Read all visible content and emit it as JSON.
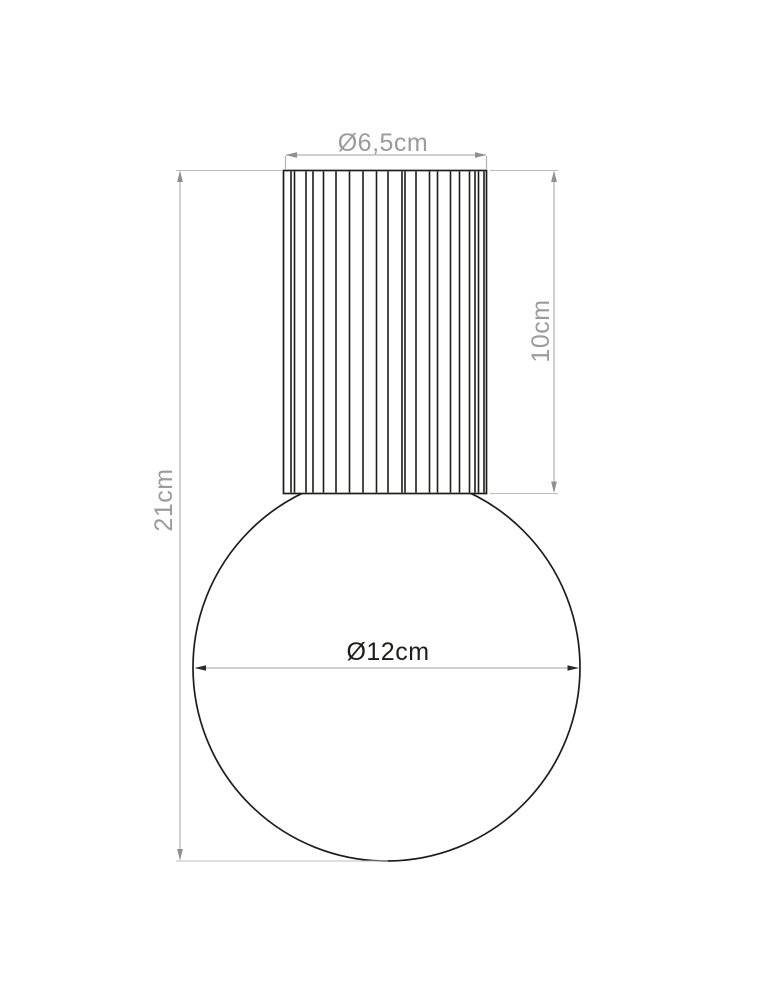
{
  "drawing": {
    "labels": {
      "top_diameter": "Ø6,5cm",
      "cylinder_height": "10cm",
      "total_height": "21cm",
      "globe_diameter": "Ø12cm"
    },
    "colors": {
      "object_line": "#1d1d1b",
      "dimension_line": "#b2b2b2",
      "extension_line": "#bcbcbc",
      "dimension_arrow": "#8f8f8f",
      "dimension_text": "#9b9b9b",
      "accent_arrow": "#2b2b2b",
      "accent_text": "#1d1d1b"
    }
  }
}
